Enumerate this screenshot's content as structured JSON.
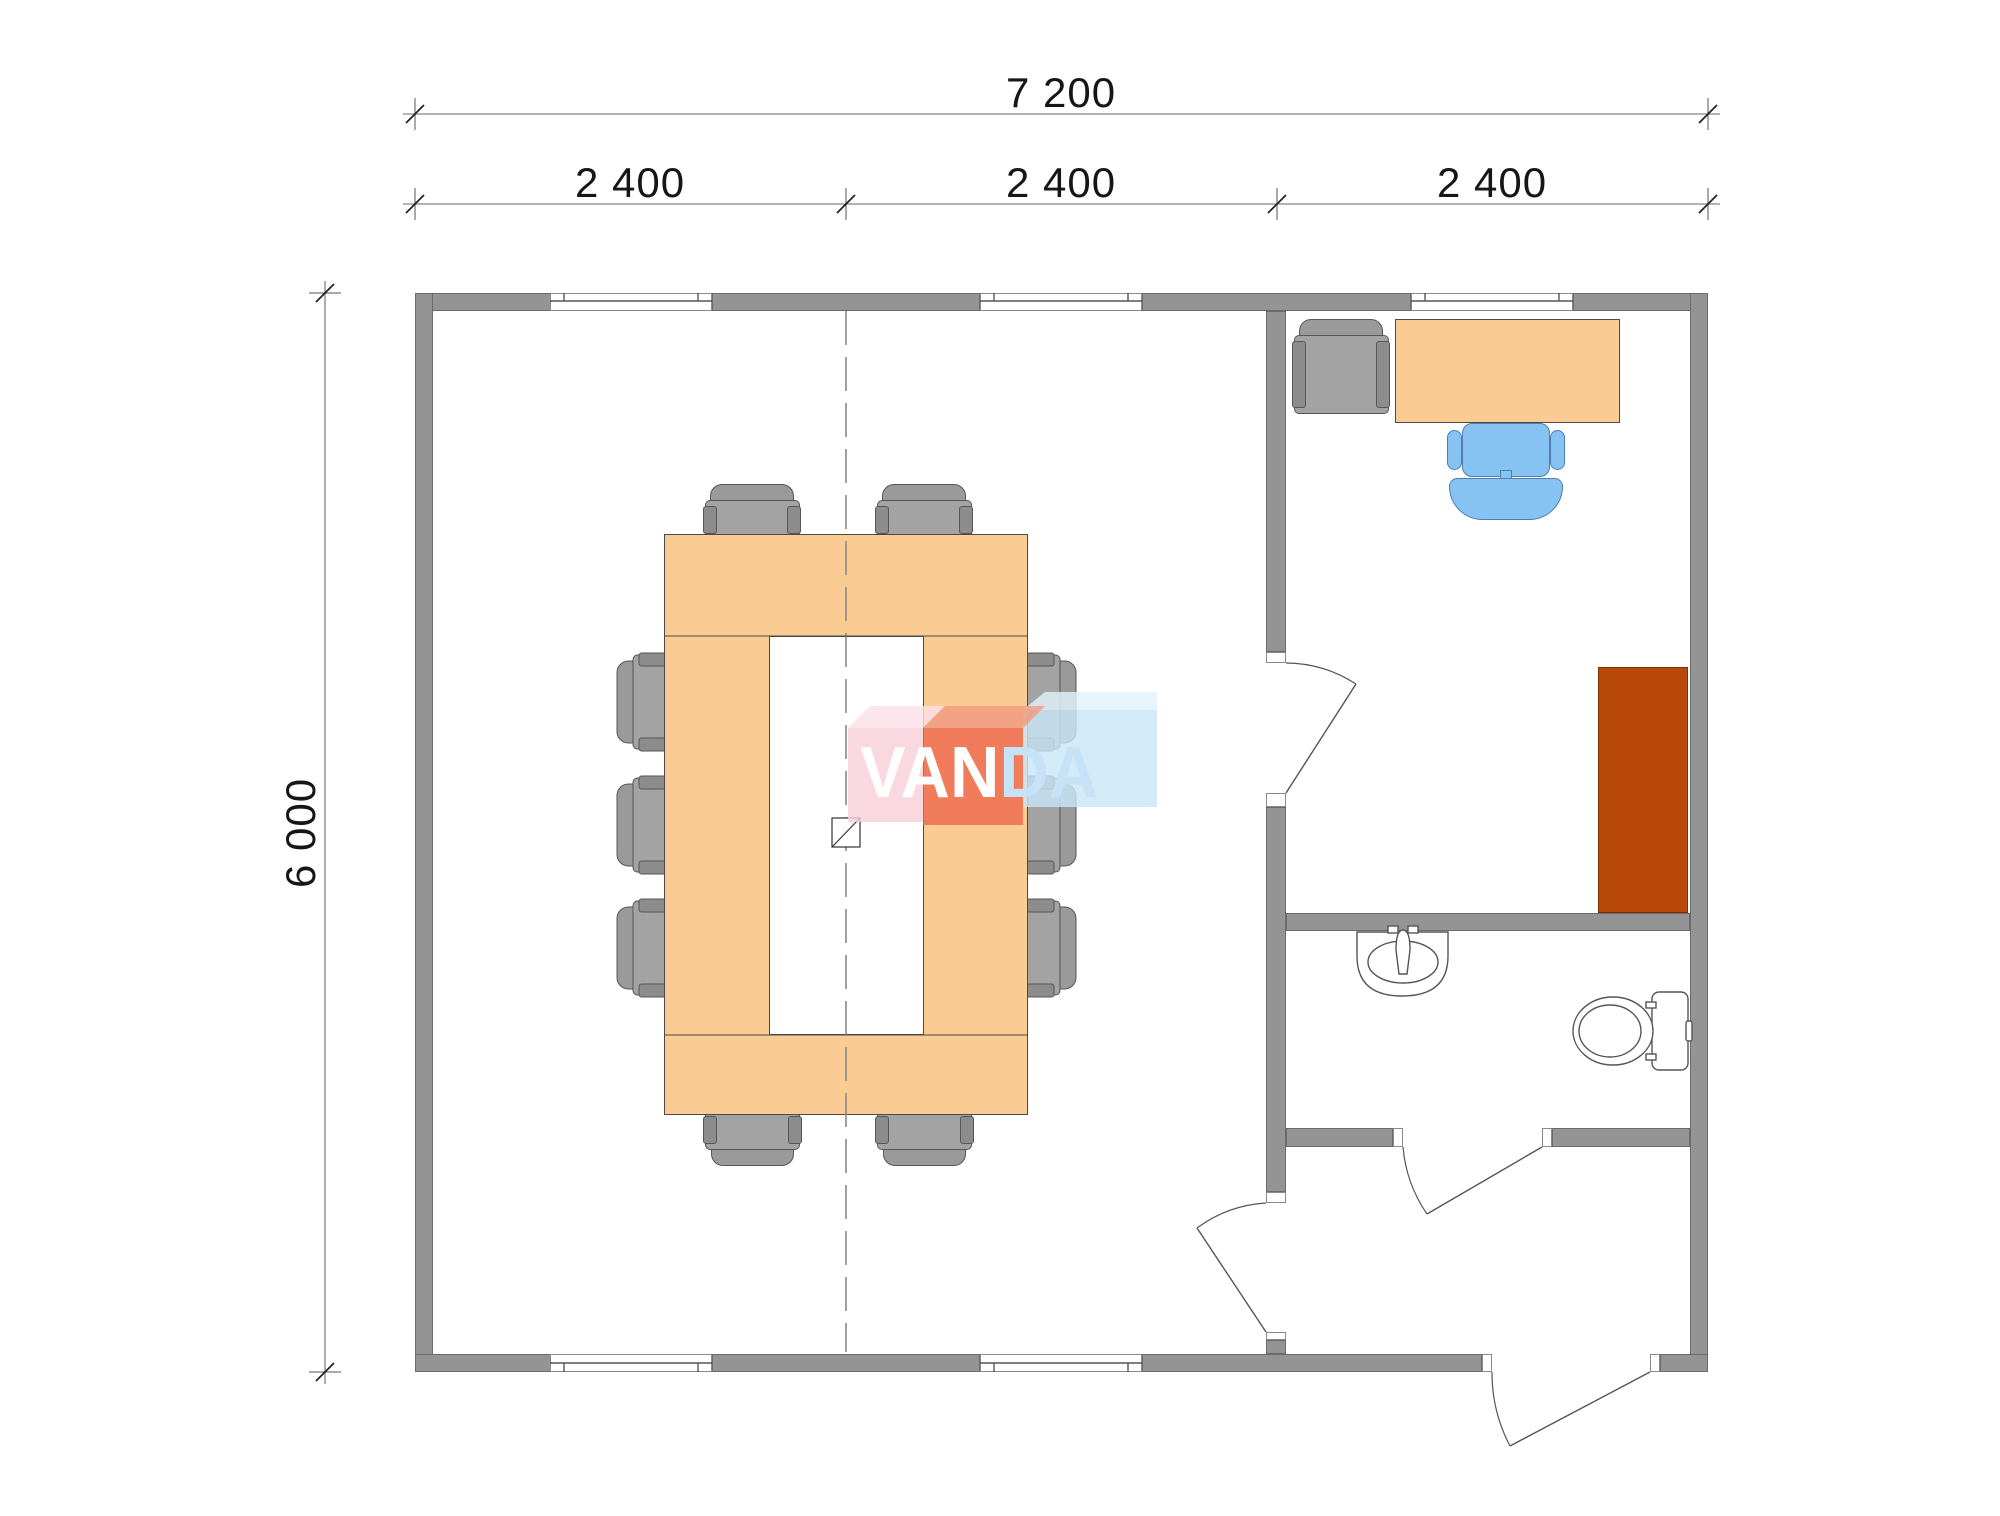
{
  "dimensions": {
    "total_width": "7 200",
    "modules": [
      "2 400",
      "2 400",
      "2 400"
    ],
    "height": "6 000"
  },
  "watermark": {
    "left": "VAN",
    "right": "DA"
  },
  "colors": {
    "wall": "#949494",
    "wallline": "#6b6b6b",
    "windowline": "#8a8a8a",
    "table": "#FACB92",
    "tableline": "#4a4a4a",
    "chairseat": "#A3A3A3",
    "chairback": "#9A9A9A",
    "chairarm": "#8C8C8C",
    "chairline": "#565656",
    "bluechair": "#86C3F2",
    "bluechairline": "#4E7FAC",
    "cabinet": "#B8490A",
    "cabinetline": "#7A3106",
    "linework": "#555555",
    "dimtext": "#161616",
    "logopink": "#F8CFD9",
    "logopinkbev": "#FBDFE8",
    "logored": "#EE6A4F",
    "logoredbev": "#F29A80",
    "logoblue": "#C9E5F7",
    "logobluebev": "#E2F1FB",
    "logotextblue": "#C6E2F6"
  }
}
